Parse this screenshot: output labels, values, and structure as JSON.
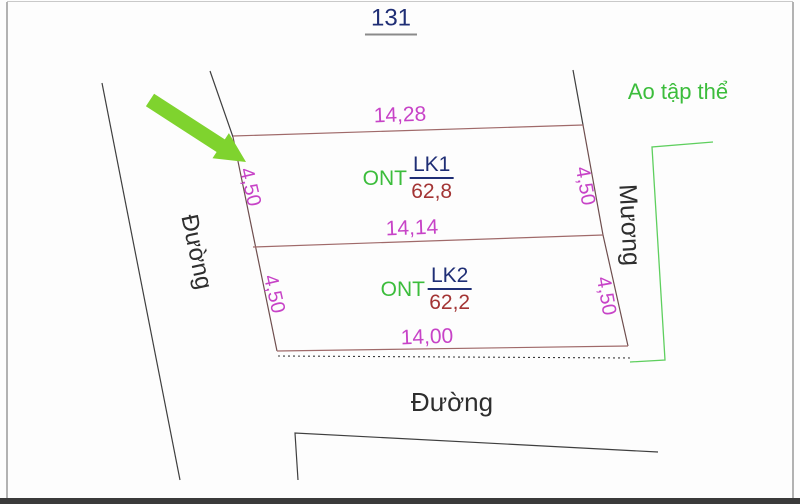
{
  "colors": {
    "navy": "#1f2e75",
    "brick": "#a33434",
    "magenta": "#c743c7",
    "green-text": "#3cbd3c",
    "arrow-green": "#7fd32e",
    "parcel-line": "#a06a6a",
    "parcel-side": "#6e4e4e",
    "road-line": "#3f3f3f",
    "green-line": "#5ecf5e",
    "frame": "#9a9a9a"
  },
  "sheet": {
    "number": "131"
  },
  "areas": {
    "pond_label": "Ao tập thể",
    "canal_label": "Mương",
    "road_left_label": "Đường",
    "road_bottom_label": "Đường"
  },
  "parcels": [
    {
      "code": "LK1",
      "land_use": "ONT",
      "area": "62,8"
    },
    {
      "code": "LK2",
      "land_use": "ONT",
      "area": "62,2"
    }
  ],
  "dimensions": {
    "top_width": "14,28",
    "middle_width": "14,14",
    "bottom_width": "14,00",
    "lk1_left_depth": "4,50",
    "lk1_right_depth": "4,50",
    "lk2_left_depth": "4,50",
    "lk2_right_depth": "4,50"
  }
}
